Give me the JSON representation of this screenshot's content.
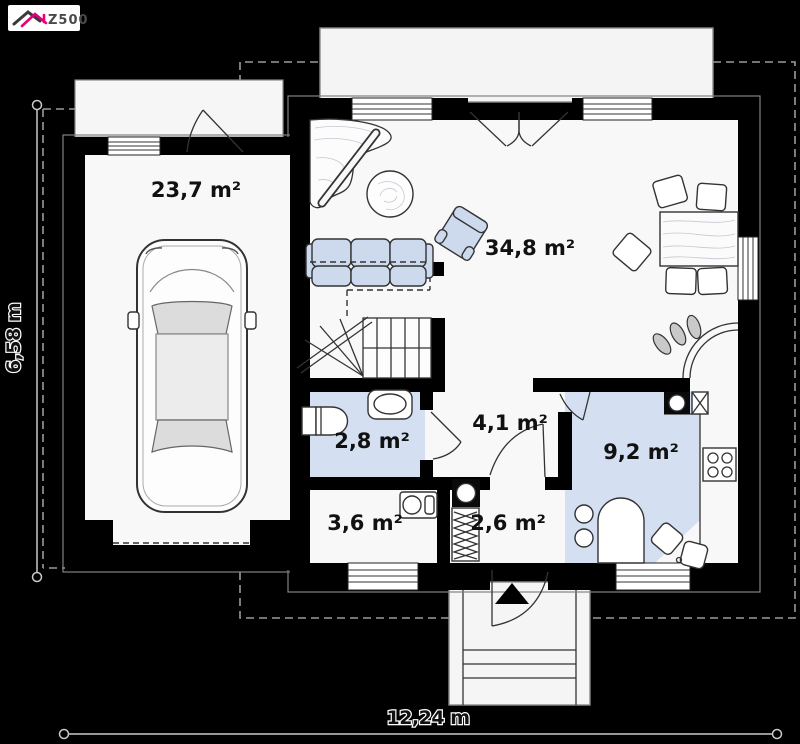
{
  "logo": {
    "text": "Z500",
    "accent_color": "#e6007e",
    "roof_dark_color": "#3a3a3a"
  },
  "rooms": {
    "garage": {
      "area": "23,7 m²"
    },
    "living": {
      "area": "34,8 m²"
    },
    "bathroom": {
      "area": "2,8 m²"
    },
    "hall": {
      "area": "4,1 m²"
    },
    "kitchen": {
      "area": "9,2 m²"
    },
    "utility": {
      "area": "3,6 m²"
    },
    "vestibule": {
      "area": "2,6 m²"
    }
  },
  "dimensions": {
    "overall_width": "12,24 m",
    "overall_depth": "6,58 m"
  },
  "colors": {
    "background": "#000000",
    "walls": "#000000",
    "floor": "#f8f8f8",
    "wet_room_floor": "#d4e0f1",
    "furniture_fill": "#cdd9ec",
    "terrace": "#f4f4f4",
    "dimension_line": "#c9c9c9",
    "label_text": "#111111"
  }
}
